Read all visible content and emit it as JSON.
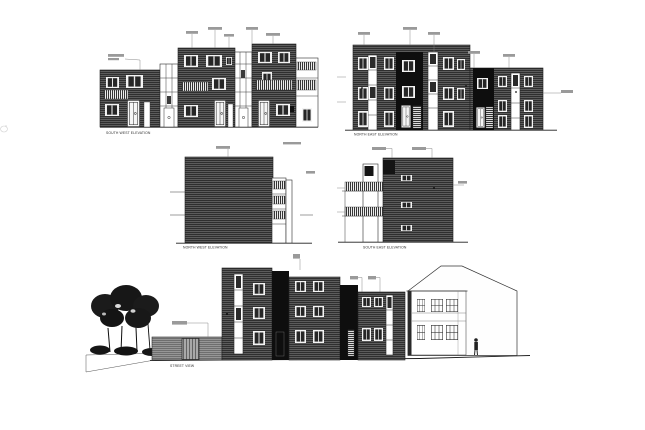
{
  "sheet": {
    "background": "#ffffff",
    "description_colors": {
      "cladding_dark": "#454545",
      "recess_black": "#0e0e0e",
      "line": "#2b2b2b",
      "annotation_gray": "#9a9a9a",
      "wall_light": "#828282"
    }
  },
  "drawings": [
    {
      "name": "south-west-elevation",
      "caption": "SOUTH WEST ELEVATION"
    },
    {
      "name": "north-east-elevation",
      "caption": "NORTH EAST ELEVATION"
    },
    {
      "name": "north-west-elevation",
      "caption": "NORTH WEST ELEVATION"
    },
    {
      "name": "south-east-elevation",
      "caption": "SOUTH EAST ELEVATION"
    },
    {
      "name": "street-view",
      "caption": "STREET VIEW"
    }
  ]
}
